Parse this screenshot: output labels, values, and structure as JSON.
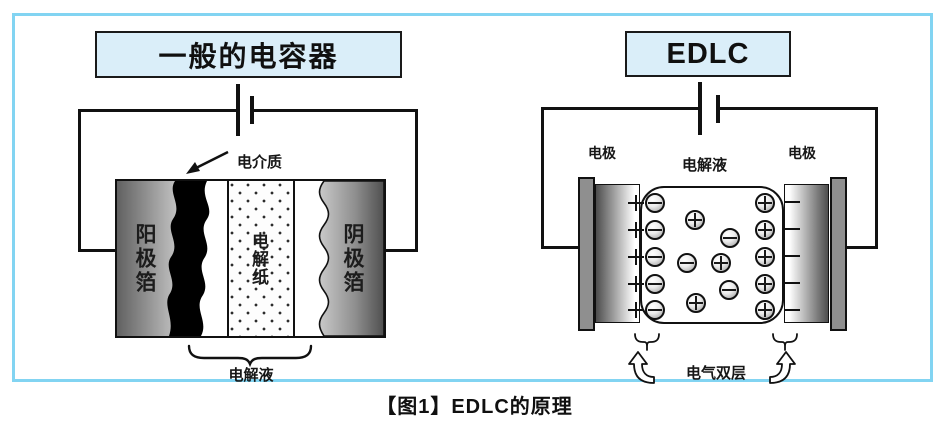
{
  "figure": {
    "caption": "【图1】EDLC的原理"
  },
  "left_diagram": {
    "title": "一般的电容器",
    "dielectric_label": "电介质",
    "anode_foil_label": "阳极箔",
    "separator_label": "电解纸",
    "cathode_foil_label": "阴极箔",
    "electrolyte_label": "电解液"
  },
  "right_diagram": {
    "title": "EDLC",
    "electrode_left_label": "电极",
    "electrolyte_label": "电解液",
    "electrode_right_label": "电极",
    "double_layer_label": "电气双层",
    "ions": [
      {
        "type": "minus",
        "x": 655,
        "y": 203
      },
      {
        "type": "minus",
        "x": 655,
        "y": 230
      },
      {
        "type": "minus",
        "x": 655,
        "y": 257
      },
      {
        "type": "minus",
        "x": 655,
        "y": 284
      },
      {
        "type": "minus",
        "x": 655,
        "y": 310
      },
      {
        "type": "plus",
        "x": 765,
        "y": 203
      },
      {
        "type": "plus",
        "x": 765,
        "y": 230
      },
      {
        "type": "plus",
        "x": 765,
        "y": 257
      },
      {
        "type": "plus",
        "x": 765,
        "y": 284
      },
      {
        "type": "plus",
        "x": 765,
        "y": 310
      },
      {
        "type": "plus",
        "x": 695,
        "y": 220
      },
      {
        "type": "minus",
        "x": 730,
        "y": 238
      },
      {
        "type": "minus",
        "x": 687,
        "y": 263
      },
      {
        "type": "plus",
        "x": 721,
        "y": 263
      },
      {
        "type": "minus",
        "x": 729,
        "y": 290
      },
      {
        "type": "plus",
        "x": 696,
        "y": 303
      }
    ],
    "electrode_marks": {
      "plus_x": 636,
      "plus_ys": [
        203,
        230,
        257,
        284,
        310
      ],
      "minus_x": 792,
      "minus_ys": [
        202,
        229,
        256,
        283,
        310
      ]
    }
  },
  "colors": {
    "frame_border": "#82d4f2",
    "title_box_bg": "#daeef9",
    "ink": "#111111"
  }
}
